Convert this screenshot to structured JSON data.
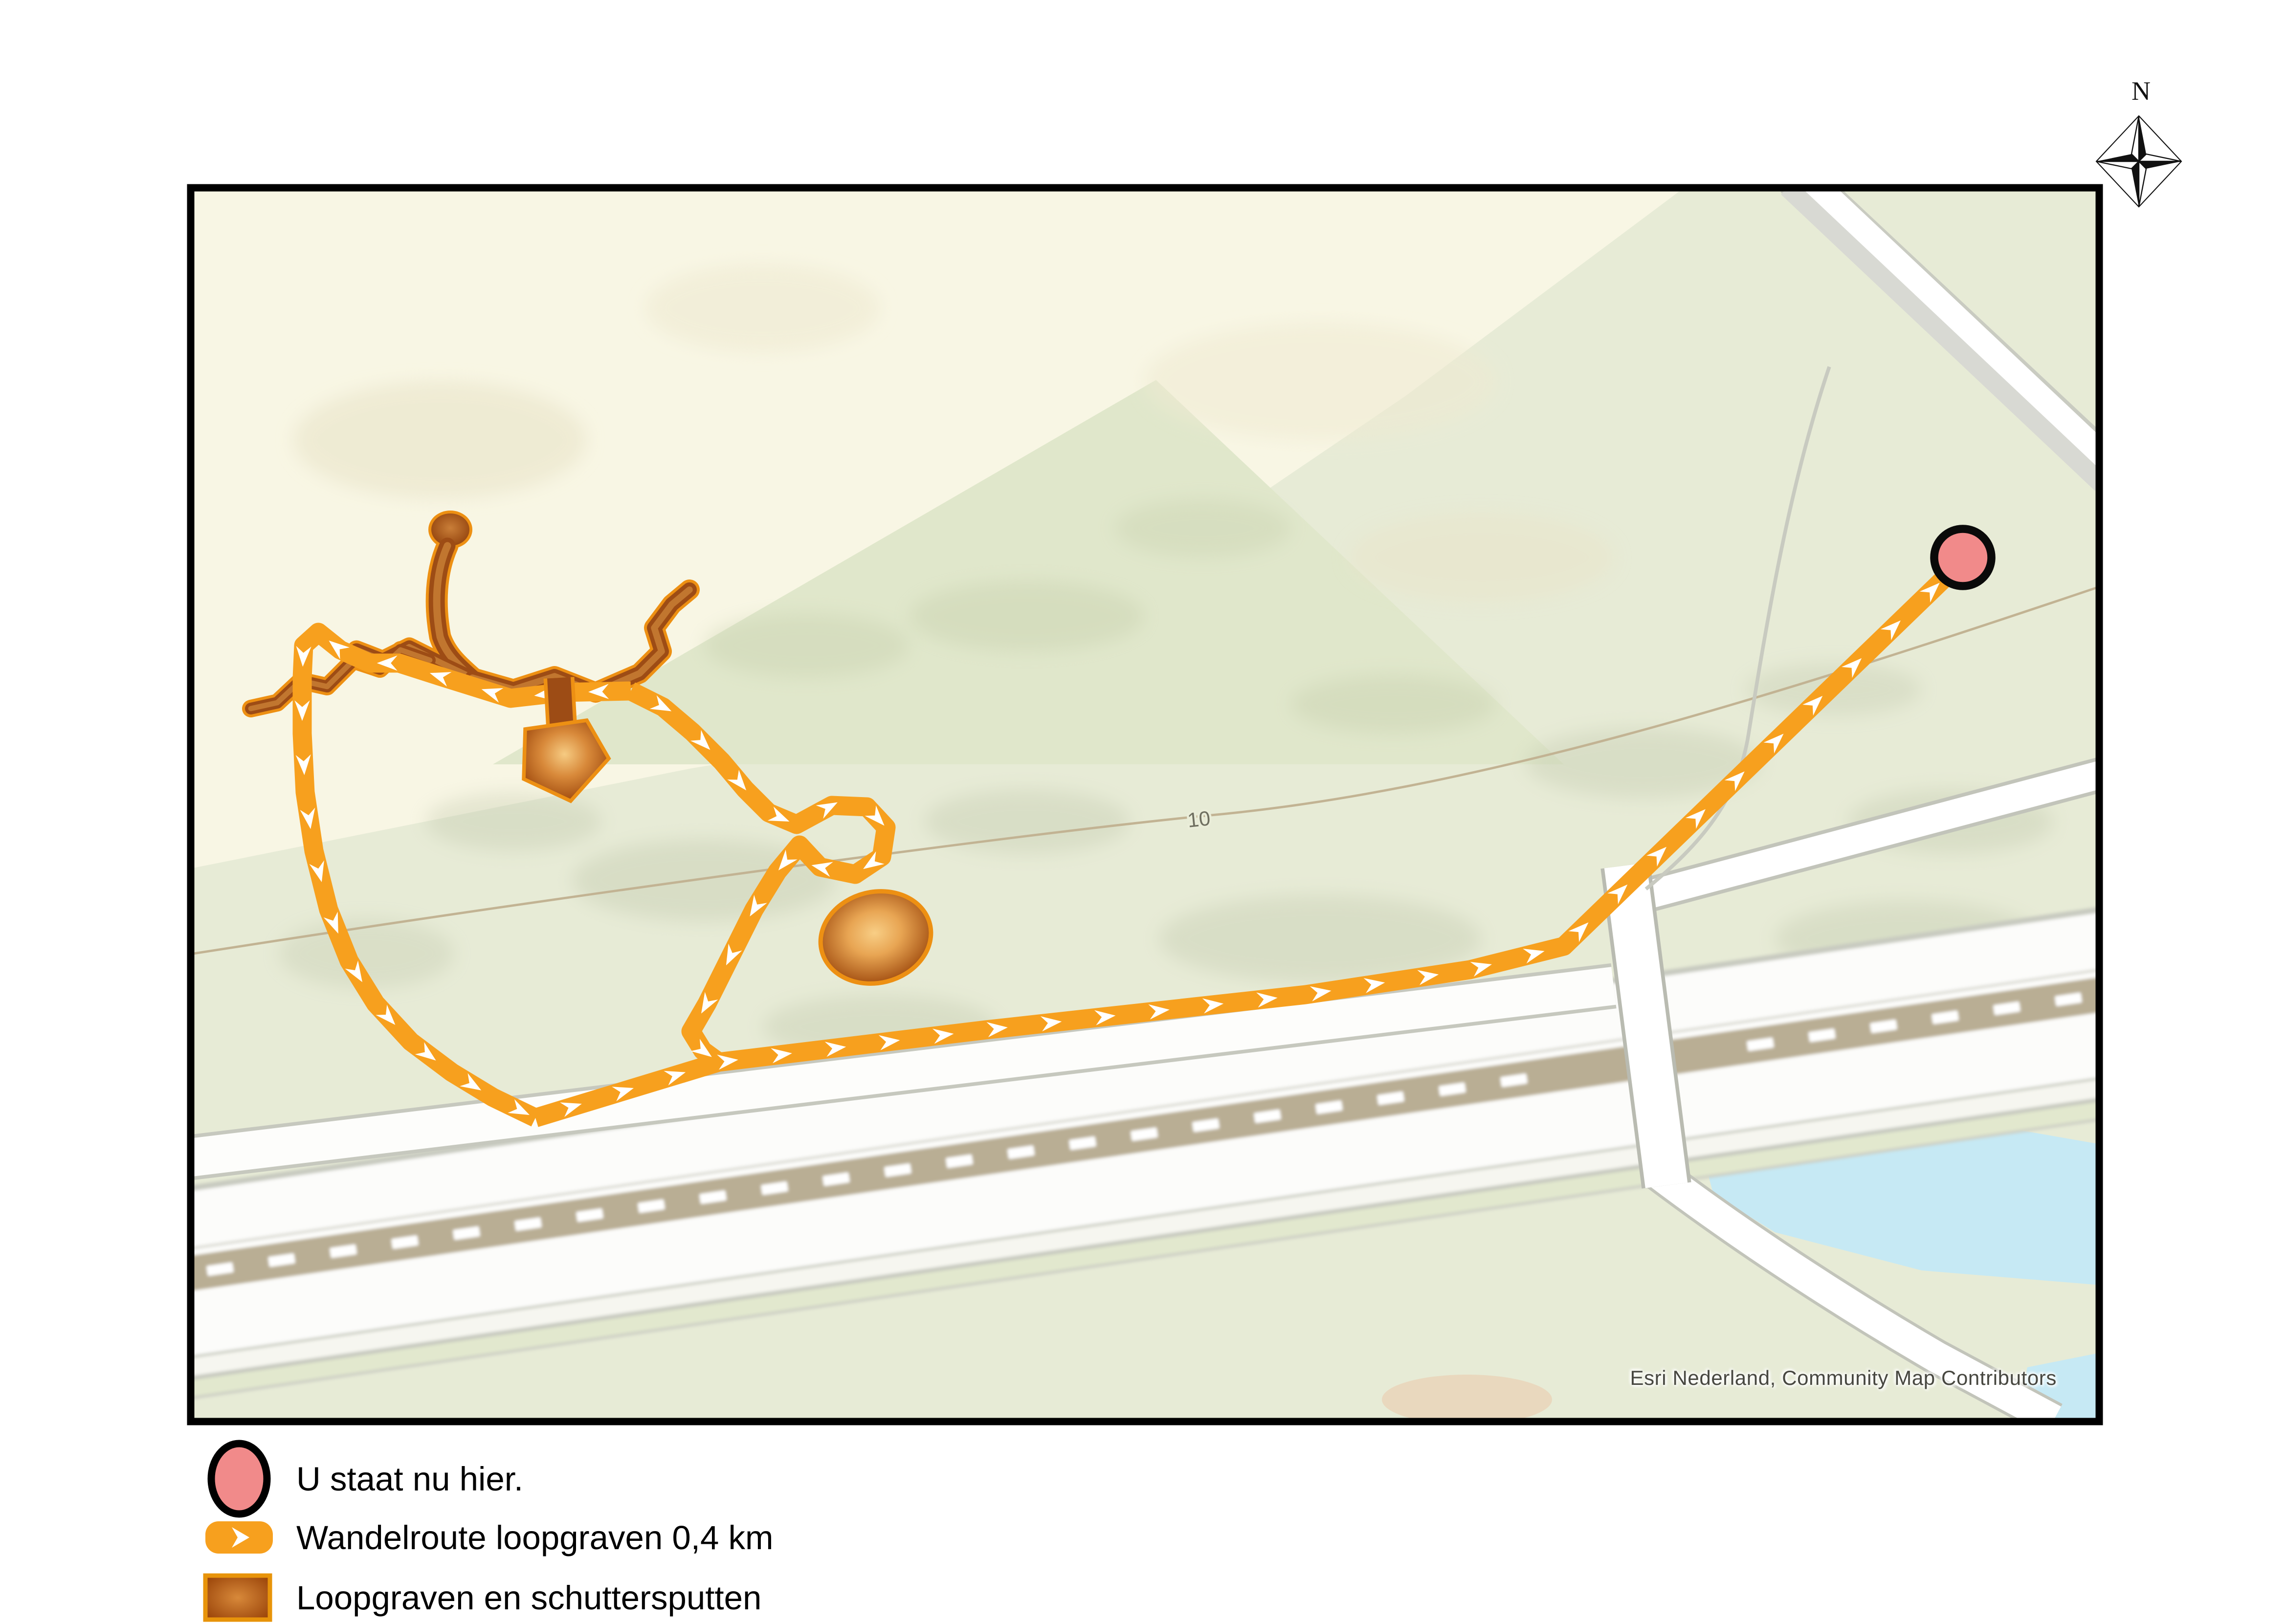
{
  "compass": {
    "north_label": "N"
  },
  "map": {
    "contour_label": "10",
    "attribution": "Esri Nederland, Community Map Contributors"
  },
  "legend": {
    "items": [
      {
        "id": "you-are-here",
        "label": "U staat nu hier."
      },
      {
        "id": "wandelroute",
        "label": "Wandelroute loopgraven 0,4 km"
      },
      {
        "id": "loopgraven",
        "label": "Loopgraven en schuttersputten"
      }
    ]
  },
  "colors": {
    "route_orange": "#F7A01E",
    "trench_dark": "#9D4C15",
    "trench_mid": "#C1762F",
    "trench_light": "#F6CB82",
    "trench_outline": "#ED9013",
    "marker_pink": "#F18A8A",
    "marker_outline": "#000000",
    "map_green": "#E7EBD6",
    "map_cream": "#F8F6E4",
    "water_blue": "#C6E9F4",
    "contour_tan": "#C2B393",
    "attribution_text": "#474740"
  }
}
